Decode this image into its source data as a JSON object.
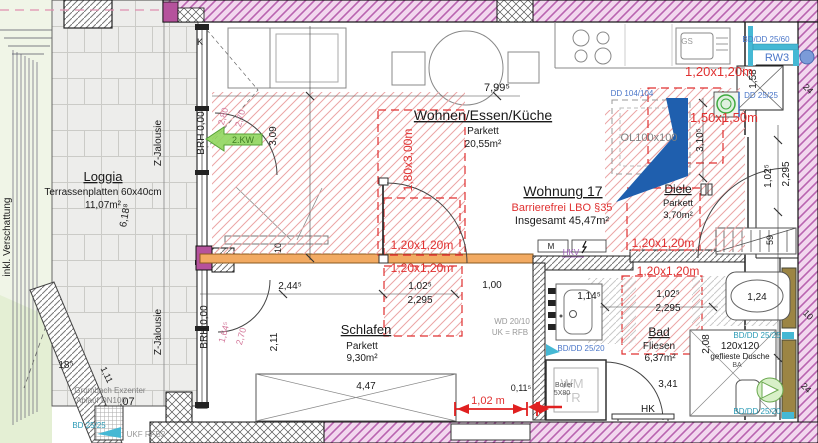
{
  "colors": {
    "black": "#1a1a1a",
    "red": "#e03030",
    "pink": "#d4799b",
    "blue": "#4a76c8",
    "teal": "#2a9ab5",
    "gray": "#999999",
    "graydark": "#808080",
    "graylight": "#c6c6c6",
    "purple": "#9b59b6",
    "green": "#3f7d22",
    "darkgray": "#555555"
  },
  "plan": {
    "width": 818,
    "height": 443,
    "type": "apartment-floor-plan"
  },
  "annotations": [
    {
      "n": "room-loggia-title",
      "t": "Loggia",
      "x": 103,
      "y": 181,
      "s": 13,
      "u": 1
    },
    {
      "n": "room-loggia-floor",
      "t": "Terrassenplatten 60x40cm",
      "x": 103,
      "y": 195
    },
    {
      "n": "room-loggia-area",
      "t": "11,07m²",
      "x": 103,
      "y": 208
    },
    {
      "n": "room-wohnen-title",
      "t": "Wohnen/Essen/Küche",
      "x": 483,
      "y": 120,
      "s": 14,
      "u": 1
    },
    {
      "n": "room-wohnen-floor",
      "t": "Parkett",
      "x": 483,
      "y": 134
    },
    {
      "n": "room-wohnen-area",
      "t": "20,55m²",
      "x": 483,
      "y": 147
    },
    {
      "n": "apartment-title",
      "t": "Wohnung 17",
      "x": 563,
      "y": 196,
      "s": 14,
      "u": 1
    },
    {
      "n": "apartment-note",
      "t": "Barrierefrei LBO §35",
      "x": 562,
      "y": 211,
      "s": 11,
      "c": "red"
    },
    {
      "n": "apartment-total",
      "t": "Insgesamt 45,47m²",
      "x": 562,
      "y": 224,
      "s": 11
    },
    {
      "n": "room-diele-title",
      "t": "Diele",
      "x": 678,
      "y": 193,
      "s": 12,
      "u": 1
    },
    {
      "n": "room-diele-floor",
      "t": "Parkett",
      "x": 678,
      "y": 206,
      "s": 9.5
    },
    {
      "n": "room-diele-area",
      "t": "3,70m²",
      "x": 678,
      "y": 218,
      "s": 9.5
    },
    {
      "n": "room-schlafen-title",
      "t": "Schlafen",
      "x": 366,
      "y": 334,
      "s": 13,
      "u": 1
    },
    {
      "n": "room-schlafen-floor",
      "t": "Parkett",
      "x": 362,
      "y": 349
    },
    {
      "n": "room-schlafen-area",
      "t": "9,30m²",
      "x": 362,
      "y": 361
    },
    {
      "n": "room-bad-title",
      "t": "Bad",
      "x": 659,
      "y": 336,
      "s": 12,
      "u": 1
    },
    {
      "n": "room-bad-floor",
      "t": "Fliesen",
      "x": 659,
      "y": 349
    },
    {
      "n": "room-bad-area",
      "t": "6,37m²",
      "x": 660,
      "y": 361
    },
    {
      "n": "dim-799",
      "t": "7,99⁵",
      "x": 497,
      "y": 91,
      "s": 11
    },
    {
      "n": "dim-309",
      "t": "3,09",
      "x": 276,
      "y": 136,
      "r": -90
    },
    {
      "n": "dim-2445",
      "t": "2,44⁵",
      "x": 290,
      "y": 289
    },
    {
      "n": "dim-1025-schlafen",
      "t": "1,02⁵",
      "x": 420,
      "y": 289
    },
    {
      "n": "dim-2295-schlafen",
      "t": "2,295",
      "x": 420,
      "y": 303
    },
    {
      "n": "dim-100",
      "t": "1,00",
      "x": 492,
      "y": 288
    },
    {
      "n": "dim-211",
      "t": "2,11",
      "x": 277,
      "y": 342,
      "r": -90
    },
    {
      "n": "dim-447",
      "t": "4,47",
      "x": 366,
      "y": 389
    },
    {
      "n": "dim-10-beam",
      "t": "10",
      "x": 281,
      "y": 248,
      "r": -90,
      "s": 9
    },
    {
      "n": "dim-1025-bad",
      "t": "1,02⁵",
      "x": 668,
      "y": 297
    },
    {
      "n": "dim-2295-bad",
      "t": "2,295",
      "x": 668,
      "y": 311
    },
    {
      "n": "dim-1145",
      "t": "1,14⁵",
      "x": 589,
      "y": 299
    },
    {
      "n": "dim-124",
      "t": "1,24",
      "x": 757,
      "y": 300
    },
    {
      "n": "dim-208",
      "t": "2,08",
      "x": 709,
      "y": 344,
      "r": -90
    },
    {
      "n": "dim-341",
      "t": "3,41",
      "x": 668,
      "y": 387
    },
    {
      "n": "dim-0115",
      "t": "0,11⁵",
      "x": 521,
      "y": 391,
      "s": 9
    },
    {
      "n": "dim-158",
      "t": "1,58",
      "x": 756,
      "y": 79,
      "r": -90
    },
    {
      "n": "dim-3105",
      "t": "3,10⁵",
      "x": 703,
      "y": 140,
      "r": -90
    },
    {
      "n": "dim-1025-right",
      "t": "1,02⁵",
      "x": 771,
      "y": 176,
      "r": -90
    },
    {
      "n": "dim-2295-right",
      "t": "2,295",
      "x": 789,
      "y": 174,
      "r": -90
    },
    {
      "n": "dim-59",
      "t": "59",
      "x": 773,
      "y": 240,
      "r": -90,
      "s": 9
    },
    {
      "n": "dim-185",
      "t": "18⁵",
      "x": 66,
      "y": 368
    },
    {
      "n": "dim-6188",
      "t": "6,18⁸",
      "x": 128,
      "y": 216,
      "r": -80
    },
    {
      "n": "dim-111",
      "t": "1,11",
      "x": 104,
      "y": 376,
      "r": 65,
      "s": 9
    },
    {
      "n": "dim-07",
      "t": ",07",
      "x": 127,
      "y": 405,
      "s": 11
    },
    {
      "n": "dim-24-top",
      "t": "24",
      "x": 806,
      "y": 91,
      "r": 45,
      "s": 9
    },
    {
      "n": "dim-10-right",
      "t": "10",
      "x": 806,
      "y": 317,
      "r": 45,
      "s": 9
    },
    {
      "n": "dim-24-bottom",
      "t": "24",
      "x": 804,
      "y": 390,
      "r": 45,
      "s": 9
    },
    {
      "n": "dim-280",
      "t": "2,80",
      "x": 226,
      "y": 117,
      "r": -75,
      "s": 9,
      "c": "pink"
    },
    {
      "n": "dim-270-top",
      "t": "2,70",
      "x": 243,
      "y": 119,
      "r": -75,
      "s": 9,
      "c": "pink"
    },
    {
      "n": "dim-1645",
      "t": "1,64⁵",
      "x": 227,
      "y": 333,
      "r": -75,
      "s": 9,
      "c": "pink"
    },
    {
      "n": "dim-270-bottom",
      "t": "2,70",
      "x": 244,
      "y": 337,
      "r": -75,
      "s": 9,
      "c": "pink"
    },
    {
      "n": "zone-120-kitchen",
      "t": "1,20x1,20m",
      "x": 719,
      "y": 76,
      "s": 13,
      "c": "red"
    },
    {
      "n": "zone-150",
      "t": "1,50x1,50m",
      "x": 724,
      "y": 122,
      "s": 13,
      "c": "red"
    },
    {
      "n": "zone-120-diele",
      "t": "1,20x1,20m",
      "x": 663,
      "y": 247,
      "s": 12,
      "c": "red"
    },
    {
      "n": "zone-120-beam-top",
      "t": "1,20x1,20m",
      "x": 422,
      "y": 249,
      "s": 12,
      "c": "red"
    },
    {
      "n": "zone-120-beam-bottom",
      "t": "1,20x1,20m",
      "x": 422,
      "y": 272,
      "s": 12,
      "c": "red"
    },
    {
      "n": "zone-120-bad",
      "t": "1,20x1,20m",
      "x": 668,
      "y": 275,
      "s": 12,
      "c": "red"
    },
    {
      "n": "zone-180x300",
      "t": "1,80x3,00m",
      "x": 412,
      "y": 160,
      "r": -90,
      "s": 12,
      "c": "red"
    },
    {
      "n": "dim-102m-red",
      "t": "1,02 m",
      "x": 488,
      "y": 404,
      "s": 11,
      "c": "red"
    },
    {
      "n": "label-bddd2560",
      "t": "BD/DD 25/60",
      "x": 766,
      "y": 42,
      "s": 8,
      "c": "blue"
    },
    {
      "n": "label-rw3",
      "t": "RW3",
      "x": 777,
      "y": 61,
      "s": 11,
      "c": "blue"
    },
    {
      "n": "label-dd104",
      "t": "DD 104/104",
      "x": 632,
      "y": 96,
      "s": 8,
      "c": "blue"
    },
    {
      "n": "label-dd2525",
      "t": "DD 25/25",
      "x": 761,
      "y": 98,
      "s": 8,
      "c": "blue"
    },
    {
      "n": "label-bddd2520-bad",
      "t": "BD/DD 25/20",
      "x": 581,
      "y": 351,
      "s": 8,
      "c": "blue"
    },
    {
      "n": "label-bddd2525-right",
      "t": "BD/DD 25/25",
      "x": 757,
      "y": 338,
      "s": 8,
      "c": "teal"
    },
    {
      "n": "label-bddd2520-bottom",
      "t": "BD/DD 25/20",
      "x": 757,
      "y": 414,
      "s": 8,
      "c": "teal"
    },
    {
      "n": "label-bd2525-loggia",
      "t": "BD 25/25",
      "x": 89,
      "y": 428,
      "s": 8,
      "c": "teal"
    },
    {
      "n": "label-wd2010",
      "t": "WD 20/10",
      "x": 512,
      "y": 324,
      "s": 8,
      "c": "gray"
    },
    {
      "n": "label-ukrfb",
      "t": "UK = RFB",
      "x": 510,
      "y": 335,
      "s": 8,
      "c": "gray"
    },
    {
      "n": "label-ukfrfb2",
      "t": "UKF RFB2",
      "x": 146,
      "y": 437,
      "s": 8,
      "c": "gray"
    },
    {
      "n": "label-gs",
      "t": "GS",
      "x": 687,
      "y": 44,
      "s": 8,
      "c": "gray"
    },
    {
      "n": "label-grumbach",
      "t": "Grumbach Exzenter",
      "x": 110,
      "y": 393,
      "s": 8,
      "c": "graydark"
    },
    {
      "n": "label-ablauf",
      "t": "Ablauf DN100",
      "x": 101,
      "y": 403,
      "s": 8,
      "c": "graydark"
    },
    {
      "n": "label-wm",
      "t": "WM",
      "x": 572,
      "y": 388,
      "s": 13,
      "c": "graylight"
    },
    {
      "n": "label-tr",
      "t": "TR",
      "x": 572,
      "y": 402,
      "s": 13,
      "c": "graylight"
    },
    {
      "n": "label-boiler",
      "t": "Boiler",
      "x": 564,
      "y": 387,
      "s": 7,
      "c": "darkgray"
    },
    {
      "n": "label-5x80",
      "t": "5X80",
      "x": 562,
      "y": 395,
      "s": 7,
      "c": "darkgray"
    },
    {
      "n": "label-ba",
      "t": "BA",
      "x": 737,
      "y": 367,
      "s": 7,
      "c": "darkgray"
    },
    {
      "n": "label-hk",
      "t": "HK",
      "x": 648,
      "y": 412,
      "s": 10
    },
    {
      "n": "label-hkv",
      "t": "HKV",
      "x": 571,
      "y": 255,
      "s": 8,
      "c": "purple"
    },
    {
      "n": "label-m",
      "t": "M",
      "x": 551,
      "y": 249,
      "s": 8
    },
    {
      "n": "label-ol100",
      "t": "OL100x100",
      "x": 649,
      "y": 141,
      "s": 11,
      "c": "graydark"
    },
    {
      "n": "label-dusche-size",
      "t": "120x120",
      "x": 740,
      "y": 349,
      "s": 10
    },
    {
      "n": "label-dusche",
      "t": "geflieste Dusche",
      "x": 740,
      "y": 359,
      "s": 8
    },
    {
      "n": "label-k",
      "t": "K",
      "x": 200,
      "y": 45,
      "s": 9
    },
    {
      "n": "label-2kw",
      "t": "2.KW",
      "x": 243,
      "y": 143,
      "s": 9,
      "c": "green"
    },
    {
      "n": "label-zjalousie-top",
      "t": "Z-Jalousie",
      "x": 161,
      "y": 143,
      "r": -90,
      "s": 10
    },
    {
      "n": "label-zjalousie-bottom",
      "t": "Z-Jalousie",
      "x": 161,
      "y": 332,
      "r": -90,
      "s": 10
    },
    {
      "n": "label-brh-top",
      "t": "BRH 0,00",
      "x": 204,
      "y": 133,
      "r": -90,
      "s": 10
    },
    {
      "n": "label-brh-bottom",
      "t": "BRH 0,00",
      "x": 207,
      "y": 327,
      "r": -90,
      "s": 10
    },
    {
      "n": "label-verschattung",
      "t": "inkl. Verschattung",
      "x": 10,
      "y": 237,
      "r": -90,
      "s": 10
    }
  ]
}
